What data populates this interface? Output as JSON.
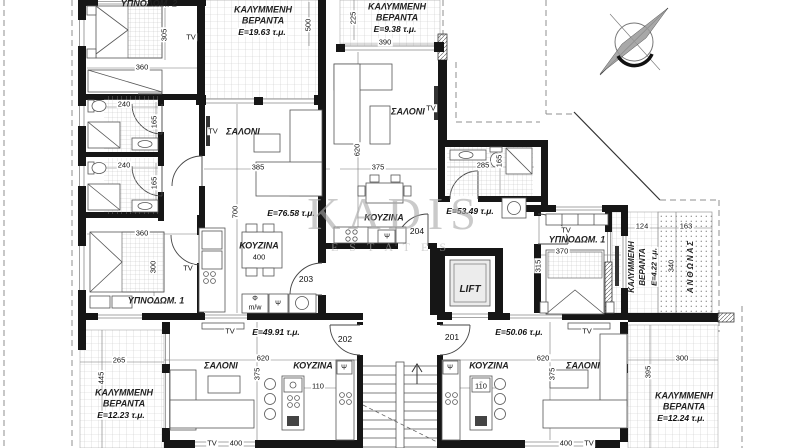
{
  "watermark": {
    "line1": "KADIS",
    "line2": "ESTATES"
  },
  "rooms": {
    "bedroom_1": "ΥΠΝΟΔΩΜ. 1",
    "bedroom_2": "ΥΠΝΟΔΩΜ. 2",
    "living": "ΣΑΛΟΝΙ",
    "kitchen": "ΚΟΥΖΙΝΑ",
    "lift": "LIFT",
    "planter": "ΑΝΘΩΝΑΣ",
    "veranda_l1": "ΚΑΛΥΜΜΕΝΗ",
    "veranda_l2": "ΒΕΡΑΝΤΑ",
    "tv": "TV"
  },
  "areas": {
    "apt_left": "E=76.58 τ.μ.",
    "apt_top": "E=53.49 τ.μ.",
    "apt_bottom_left": "E=49.91 τ.μ.",
    "apt_bottom_right": "E=50.06 τ.μ.",
    "veranda_top_left": "Ε=19.63 τ.μ.",
    "veranda_top_center": "Ε=9.38 τ.μ.",
    "veranda_right": "Ε=4.22 τ.μ.",
    "veranda_bottom_left": "Ε=12.23 τ.μ.",
    "veranda_bottom_right": "Ε=12.24 τ.μ."
  },
  "doors": {
    "d201": "201",
    "d202": "202",
    "d203": "203",
    "d204": "204"
  },
  "dims": {
    "d110": "110",
    "d124": "124",
    "d163": "163",
    "d165": "165",
    "d225": "225",
    "d240": "240",
    "d265": "265",
    "d285": "285",
    "d300": "300",
    "d305": "305",
    "d315": "315",
    "d340": "340",
    "d360": "360",
    "d370": "370",
    "d375": "375",
    "d385": "385",
    "d390": "390",
    "d395": "395",
    "d400": "400",
    "d445": "445",
    "d500": "500",
    "d620": "620",
    "d700": "700"
  },
  "symbols": {
    "sink": "Ψ",
    "phi": "Φ",
    "micro_label": "m/w"
  }
}
